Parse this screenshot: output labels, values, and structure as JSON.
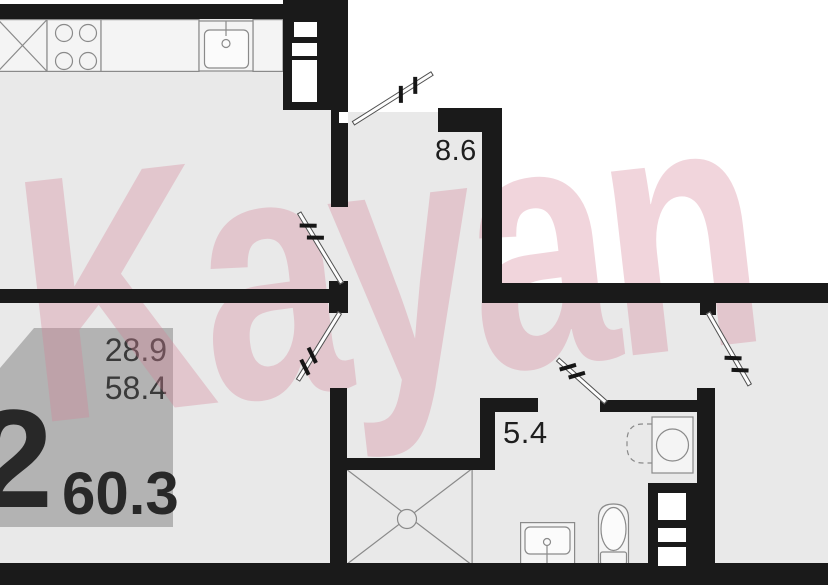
{
  "watermark": {
    "text": "Kayan",
    "color": "#d68096"
  },
  "area_labels": {
    "corridor": "8.6",
    "bathroom": "5.4"
  },
  "info_badge": {
    "rooms_count": "2",
    "top_value": "28.9",
    "middle_value": "58.4",
    "bottom_value": "60.3",
    "background": "#b3b3b3"
  },
  "colors": {
    "wall": "#1a1a1a",
    "floor": "#e9e9e9",
    "outside": "#ffffff",
    "fixture_outline": "#8a8a8a"
  },
  "fixtures": {
    "kitchen": [
      "base-cabinet",
      "stove-4-burner",
      "countertop",
      "kitchen-sink"
    ],
    "bathroom": [
      "washing-machine",
      "bathroom-sink",
      "toilet",
      "shower-cabin"
    ],
    "shafts": [
      "kitchen-vent-shaft",
      "bathroom-vent-shaft"
    ],
    "doors": [
      "entry-door",
      "living-room-door",
      "bedroom-door",
      "room-door",
      "bathroom-door"
    ]
  }
}
